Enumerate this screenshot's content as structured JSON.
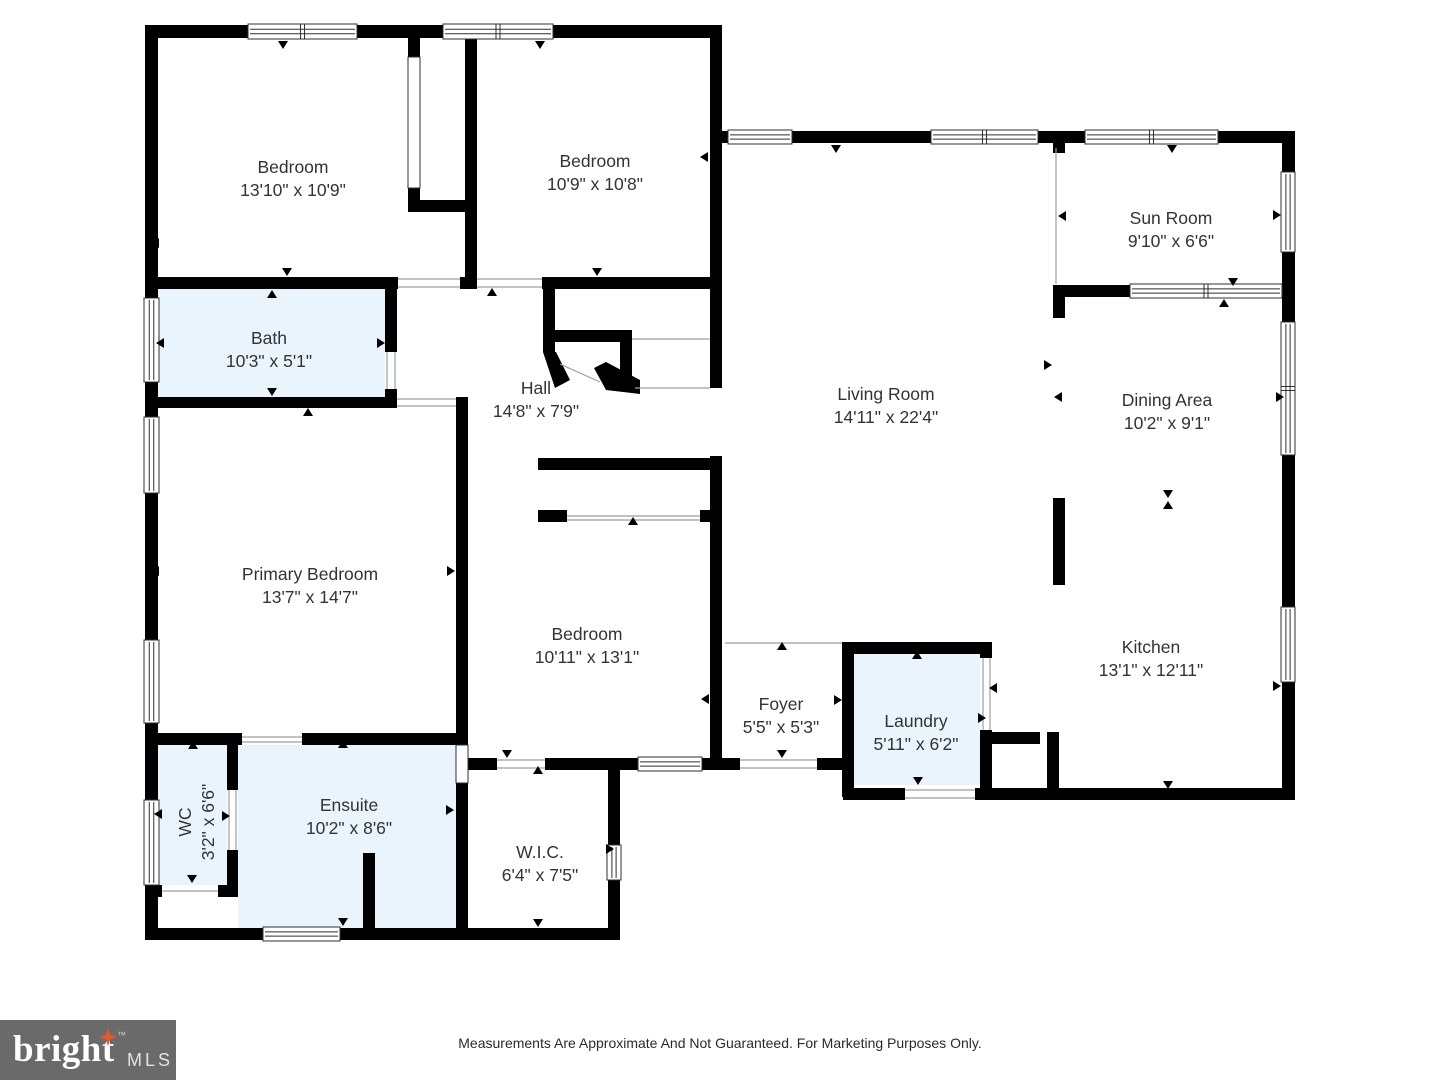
{
  "floor_plan": {
    "rooms": [
      {
        "id": "bedroom-1",
        "name": "Bedroom",
        "dims": "13'10\" x 10'9\"",
        "highlighted": false
      },
      {
        "id": "bedroom-2",
        "name": "Bedroom",
        "dims": "10'9\" x 10'8\"",
        "highlighted": false
      },
      {
        "id": "sun-room",
        "name": "Sun Room",
        "dims": "9'10\" x 6'6\"",
        "highlighted": false
      },
      {
        "id": "living-room",
        "name": "Living Room",
        "dims": "14'11\" x 22'4\"",
        "highlighted": false
      },
      {
        "id": "dining-area",
        "name": "Dining Area",
        "dims": "10'2\" x 9'1\"",
        "highlighted": false
      },
      {
        "id": "bath",
        "name": "Bath",
        "dims": "10'3\" x 5'1\"",
        "highlighted": true
      },
      {
        "id": "hall",
        "name": "Hall",
        "dims": "14'8\" x 7'9\"",
        "highlighted": false
      },
      {
        "id": "primary-bedroom",
        "name": "Primary Bedroom",
        "dims": "13'7\" x 14'7\"",
        "highlighted": false
      },
      {
        "id": "bedroom-3",
        "name": "Bedroom",
        "dims": "10'11\" x 13'1\"",
        "highlighted": false
      },
      {
        "id": "kitchen",
        "name": "Kitchen",
        "dims": "13'1\" x 12'11\"",
        "highlighted": false
      },
      {
        "id": "foyer",
        "name": "Foyer",
        "dims": "5'5\" x 5'3\"",
        "highlighted": false
      },
      {
        "id": "laundry",
        "name": "Laundry",
        "dims": "5'11\" x 6'2\"",
        "highlighted": true
      },
      {
        "id": "wc",
        "name": "WC",
        "dims": "3'2\" x 6'6\"",
        "highlighted": true
      },
      {
        "id": "ensuite",
        "name": "Ensuite",
        "dims": "10'2\" x 8'6\"",
        "highlighted": true
      },
      {
        "id": "wic",
        "name": "W.I.C.",
        "dims": "6'4\" x 7'5\"",
        "highlighted": false
      }
    ],
    "footer_disclaimer": "Measurements Are Approximate And Not Guaranteed. For Marketing Purposes Only.",
    "logo": {
      "brand": "bright",
      "tm": "™",
      "suffix": "MLS"
    },
    "colors": {
      "wall": "#000000",
      "room_highlight": "#e9f4fc",
      "label_text": "#333333",
      "logo_background": "#6a6a6a",
      "logo_star": "#e4572e"
    }
  }
}
